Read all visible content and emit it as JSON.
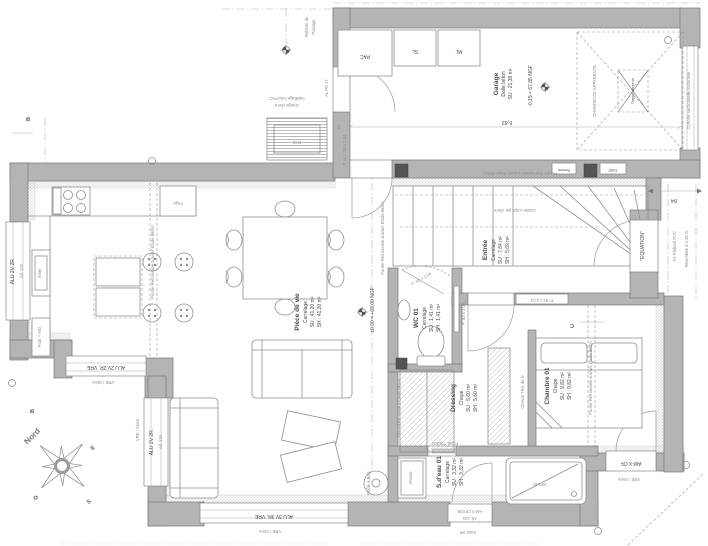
{
  "plan": {
    "rooms": {
      "garage": {
        "name": "Garage",
        "floor": "Dalle béton",
        "su": "SU : 21,38 m²"
      },
      "piece_de_vie": {
        "name": "Pièce de vie",
        "floor": "Carrelage",
        "su": "SU : 41,20 m²",
        "sh": "SH : 41,20 m²"
      },
      "entree": {
        "name": "Entrée",
        "floor": "Carrelage",
        "su": "SU : 7,84 m²",
        "sh": "SH : 5,69 m²"
      },
      "wc01": {
        "name": "WC 01",
        "floor": "Carrelage",
        "su": "SU : 1,41 m²",
        "sh": "SH : 1,41 m²"
      },
      "chambre01": {
        "name": "Chambre 01",
        "floor": "Chape",
        "su": "SU : 9,82 m²",
        "sh": "SH : 9,82 m²"
      },
      "dressing": {
        "name": "Dressing",
        "floor": "Chape",
        "su": "SU : 5,60 m²",
        "sh": "SH : 5,60 m²"
      },
      "sdeau01": {
        "name": "S.d'eau 01",
        "floor": "Carrelage",
        "su": "SU : 3,32 m²",
        "sh": "SH : 3,32 m²"
      }
    },
    "equipment": {
      "pac": "PAC",
      "sl": "SL",
      "ml": "ML",
      "frigo": "Frigo",
      "four_mo": "Four + MO",
      "evier": "Évier",
      "attente": "Attente",
      "poele": "Poêle à Bois",
      "tgbt": "TGBT",
      "pieuvre": "Pieuvre"
    },
    "doors": {
      "service": "AL PS 1T",
      "iso": "P. Iso.: 83 x 2,04",
      "int83": "P: 83 x 2,04",
      "galandage": "P.Gal. 73x204",
      "sectionnelle": "Porte sectionnelle motorisée"
    },
    "windows": {
      "alu2v2r": "ALU 2V 2R.",
      "all120": "All. 120",
      "alu2v2r_vre": "ALU 2V 2R. VRE",
      "alu3v3r_vre": "ALU 3V 3R. VRE",
      "amx_ofob": "AM-X OF/OB",
      "amx_of": "AM-X OF",
      "vre_store": "VRE / Store",
      "sans_vr": "Sans VR"
    },
    "levels": {
      "rdc": "±0,00 = +68,00 NGF",
      "garage": "-0,15 = 67,85 NGF"
    },
    "notes": {
      "charpente": "CHARPENTE APPARENTE",
      "trappe": "Trappe accès vs",
      "poutre": "Poutre Retroussée suivant Étude Béton",
      "retombee": "Retombée suivant Étude Béton",
      "garde_corps": "Garde-corps par client",
      "cloison": "Cloison Tête de lit",
      "equation": "\"EQUATION\"",
      "fx_plafond": "Fx Plafond PVC",
      "retombee_235": "Retombée à 2,35 m",
      "habillage_1": "habillage bois PAC",
      "habillage_2": "charge client",
      "robinet_1": "Robinet de",
      "robinet_2": "Puisage",
      "shower": "90*140"
    },
    "dims": {
      "garage_w": "6,82",
      "porch": "84",
      "w22": "22"
    },
    "compass": {
      "n": "Nord",
      "e": "E",
      "s": "S",
      "o": "O"
    },
    "sections": {
      "b": "B",
      "c": "C"
    }
  }
}
